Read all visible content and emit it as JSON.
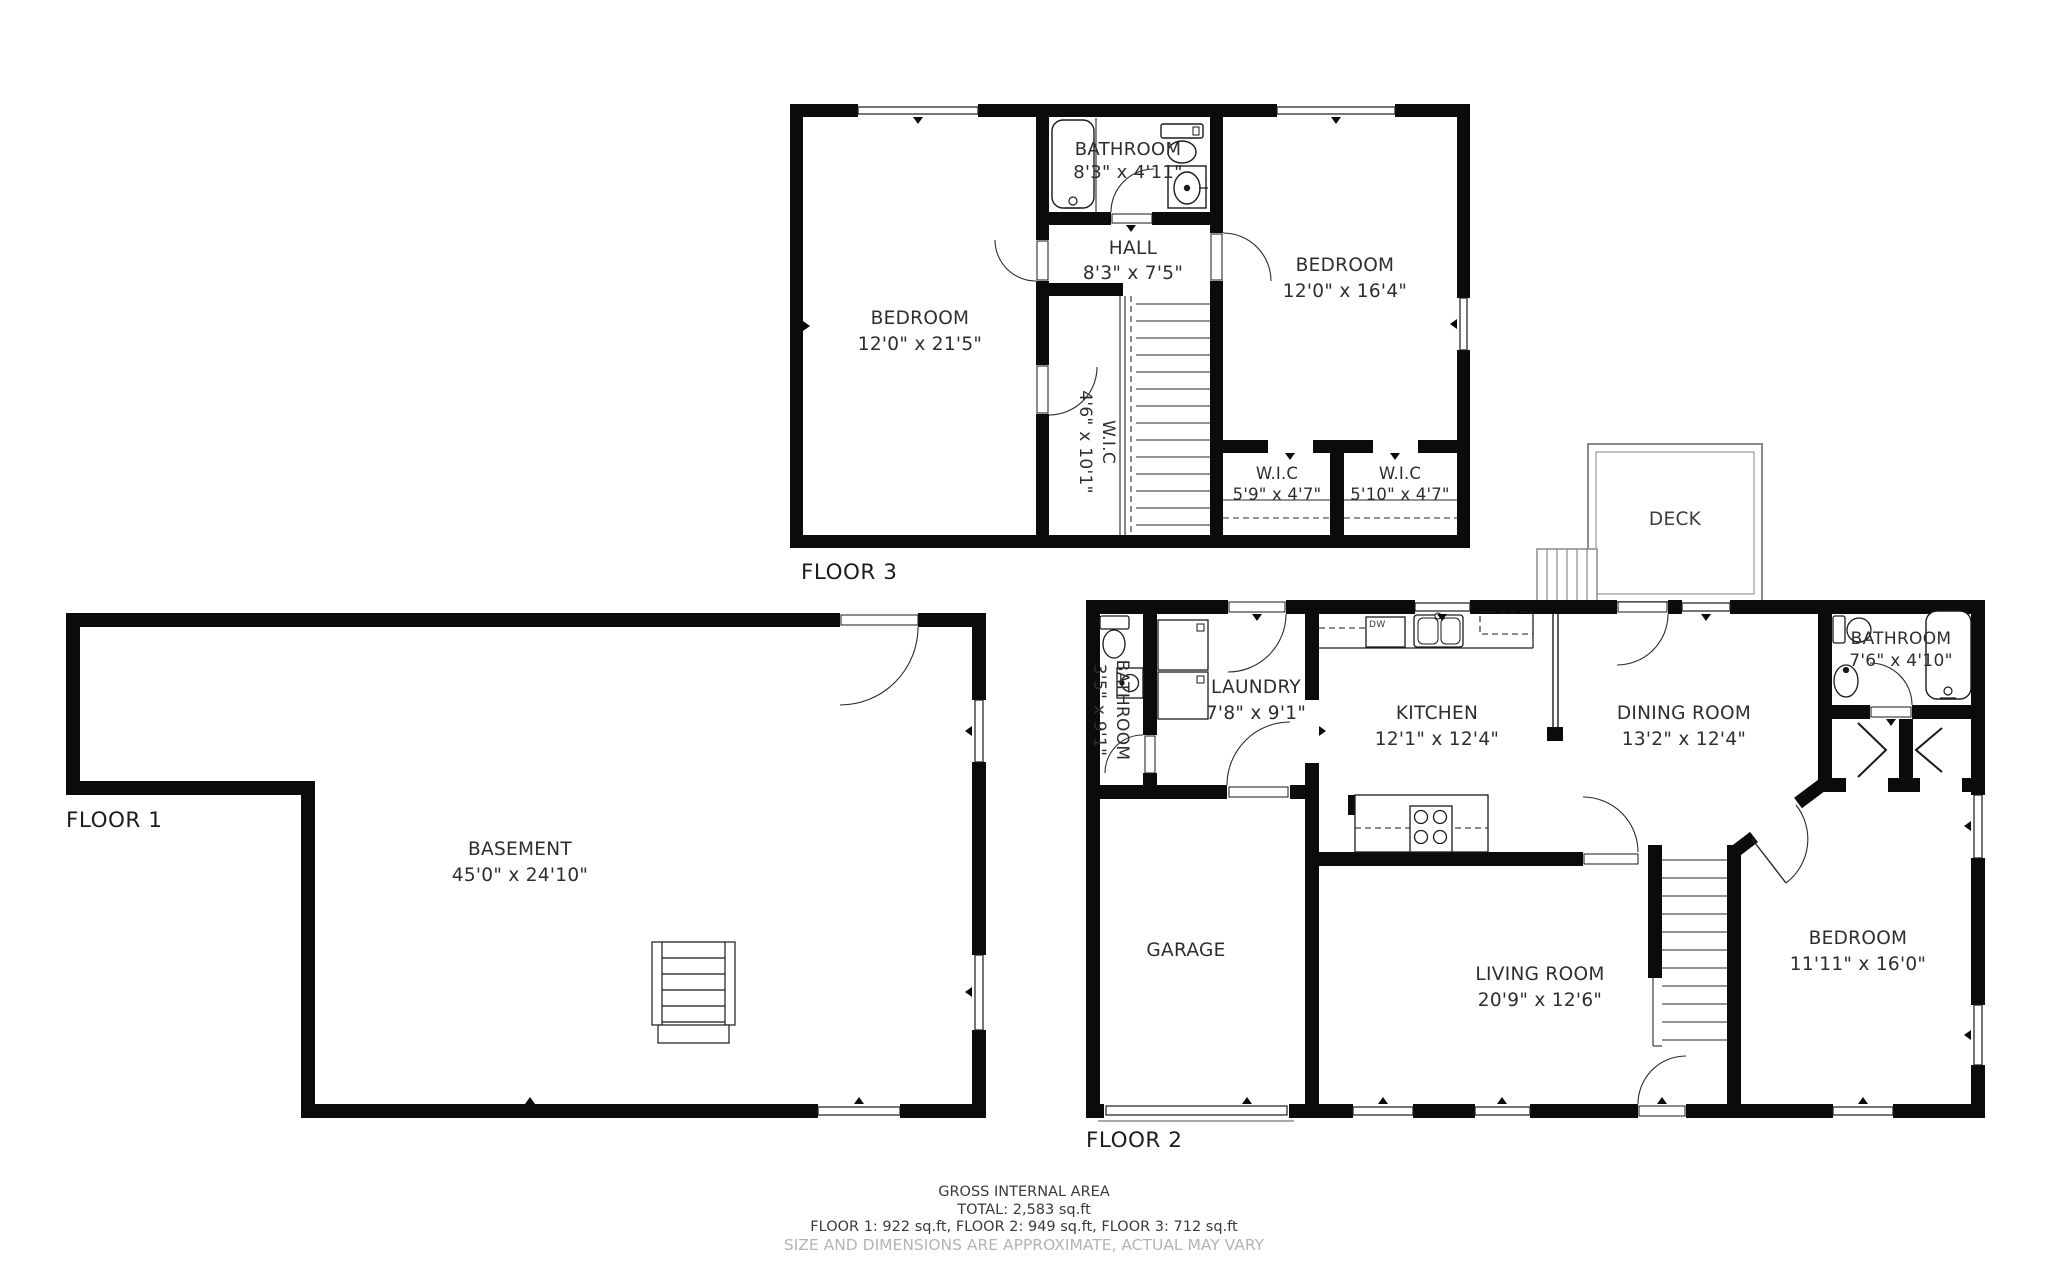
{
  "plan": {
    "floor_labels": {
      "f1": "FLOOR 1",
      "f2": "FLOOR 2",
      "f3": "FLOOR 3"
    },
    "rooms": {
      "f3_bedroom_left": {
        "name": "BEDROOM",
        "dims": "12'0\" x 21'5\""
      },
      "f3_bathroom": {
        "name": "BATHROOM",
        "dims": "8'3\" x 4'11\""
      },
      "f3_hall": {
        "name": "HALL",
        "dims": "8'3\" x 7'5\""
      },
      "f3_bedroom_right": {
        "name": "BEDROOM",
        "dims": "12'0\" x 16'4\""
      },
      "f3_wic_tall": {
        "name": "W.I.C",
        "dims": "4'6\" x 10'1\""
      },
      "f3_wic_left": {
        "name": "W.I.C",
        "dims": "5'9\" x 4'7\""
      },
      "f3_wic_right": {
        "name": "W.I.C",
        "dims": "5'10\" x 4'7\""
      },
      "deck": {
        "name": "DECK"
      },
      "f1_basement": {
        "name": "BASEMENT",
        "dims": "45'0\" x 24'10\""
      },
      "f2_bathroom_left": {
        "name": "BATHROOM",
        "dims": "3'5\" x 9'1\""
      },
      "f2_laundry": {
        "name": "LAUNDRY",
        "dims": "7'8\" x 9'1\""
      },
      "f2_kitchen": {
        "name": "KITCHEN",
        "dims": "12'1\" x 12'4\""
      },
      "f2_dining": {
        "name": "DINING ROOM",
        "dims": "13'2\" x 12'4\""
      },
      "f2_bathroom_right": {
        "name": "BATHROOM",
        "dims": "7'6\" x 4'10\""
      },
      "f2_garage": {
        "name": "GARAGE"
      },
      "f2_living": {
        "name": "LIVING ROOM",
        "dims": "20'9\" x 12'6\""
      },
      "f2_bedroom": {
        "name": "BEDROOM",
        "dims": "11'11\" x 16'0\""
      }
    },
    "appliances": {
      "dishwasher": "DW"
    },
    "footer": {
      "line1": "GROSS INTERNAL AREA",
      "line2": "TOTAL: 2,583 sq.ft",
      "line3": "FLOOR 1: 922 sq.ft, FLOOR 2: 949 sq.ft, FLOOR 3: 712 sq.ft",
      "line4": "SIZE AND DIMENSIONS ARE APPROXIMATE, ACTUAL MAY VARY"
    },
    "colors": {
      "wall": "#0b0b0b",
      "thin_line": "#2a2a2a",
      "deck_line": "#8a8a8a",
      "muted_text": "#b4b4b4",
      "text": "#2e2e2e"
    }
  }
}
